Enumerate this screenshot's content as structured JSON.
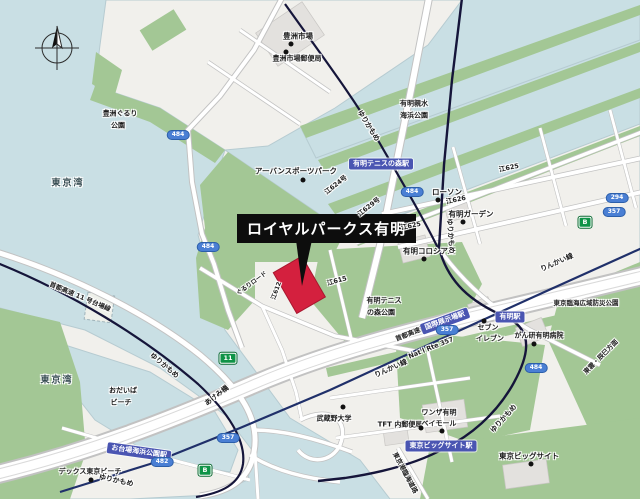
{
  "title": {
    "text": "ロイヤルパークス有明"
  },
  "colors": {
    "water": "#c9dfe4",
    "land": "#f1f0ec",
    "park": "#a3c795",
    "marker_red": "#d4203e",
    "rail_dark": "#15153a",
    "rinkai_blue": "#20306a",
    "station_badge_blue": "#4a55b2",
    "route_badge_blue": "#4a7fd4",
    "shield_green": "#0f9347"
  },
  "compass": {
    "name": "north-compass"
  },
  "sea_labels": [
    {
      "name": "tokyo-bay-north",
      "text": "東京湾",
      "x": 68,
      "y": 184,
      "s": 9
    },
    {
      "name": "tokyo-bay-south",
      "text": "東京湾",
      "x": 57,
      "y": 381,
      "s": 9
    }
  ],
  "poi_labels": [
    {
      "name": "toyosu-market",
      "text": "豊洲市場",
      "x": 298,
      "y": 36,
      "s": 7.5
    },
    {
      "name": "toyosu-post-office",
      "text": "豊洲市場郵便局",
      "x": 297,
      "y": 59,
      "s": 7
    },
    {
      "name": "toyosu-gururi-park-1",
      "text": "豊洲ぐるり",
      "x": 120,
      "y": 114,
      "s": 7
    },
    {
      "name": "toyosu-gururi-park-2",
      "text": "公園",
      "x": 118,
      "y": 126,
      "s": 7
    },
    {
      "name": "urban-sports-park",
      "text": "アーバンスポーツパーク",
      "x": 296,
      "y": 171,
      "s": 7.5
    },
    {
      "name": "shinsui-park-1",
      "text": "有明親水",
      "x": 414,
      "y": 104,
      "s": 7
    },
    {
      "name": "shinsui-park-2",
      "text": "海浜公園",
      "x": 414,
      "y": 116,
      "s": 7
    },
    {
      "name": "lawson",
      "text": "ローソン",
      "x": 447,
      "y": 192,
      "s": 7.5
    },
    {
      "name": "ariake-garden",
      "text": "有明ガーデン",
      "x": 471,
      "y": 214,
      "s": 7.5
    },
    {
      "name": "ariake-coliseum",
      "text": "有明コロシアム",
      "x": 429,
      "y": 251,
      "s": 7.5
    },
    {
      "name": "tennis-forest-park-1",
      "text": "有明テニス",
      "x": 384,
      "y": 301,
      "s": 7
    },
    {
      "name": "tennis-forest-park-2",
      "text": "の森公園",
      "x": 381,
      "y": 313,
      "s": 7
    },
    {
      "name": "seven-eleven-1",
      "text": "セブン",
      "x": 488,
      "y": 328,
      "s": 7
    },
    {
      "name": "seven-eleven-2",
      "text": "イレブン",
      "x": 490,
      "y": 339,
      "s": 7
    },
    {
      "name": "cancer-hospital",
      "text": "がん研有明病院",
      "x": 539,
      "y": 336,
      "s": 7
    },
    {
      "name": "bousai-park",
      "text": "東京臨海広域防災公園",
      "x": 586,
      "y": 303,
      "s": 6.5
    },
    {
      "name": "musashino-univ",
      "text": "武蔵野大学",
      "x": 334,
      "y": 419,
      "s": 7
    },
    {
      "name": "tft-post-office",
      "text": "TFT 内郵便局",
      "x": 400,
      "y": 425,
      "s": 7
    },
    {
      "name": "wanza-ariake-1",
      "text": "ワンザ有明",
      "x": 439,
      "y": 413,
      "s": 7
    },
    {
      "name": "wanza-ariake-2",
      "text": "ベイモール",
      "x": 439,
      "y": 424,
      "s": 7
    },
    {
      "name": "tokyo-big-sight",
      "text": "東京ビッグサイト",
      "x": 529,
      "y": 456,
      "s": 7.5
    },
    {
      "name": "odaiba-beach-1",
      "text": "おだいば",
      "x": 123,
      "y": 391,
      "s": 7
    },
    {
      "name": "odaiba-beach-2",
      "text": "ビーチ",
      "x": 121,
      "y": 403,
      "s": 7
    },
    {
      "name": "decks-tokyo-beach",
      "text": "デックス東京ビーチ",
      "x": 90,
      "y": 472,
      "s": 7
    }
  ],
  "poi_dots": [
    {
      "x": 291,
      "y": 44
    },
    {
      "x": 286,
      "y": 52
    },
    {
      "x": 303,
      "y": 180
    },
    {
      "x": 438,
      "y": 200
    },
    {
      "x": 463,
      "y": 222
    },
    {
      "x": 424,
      "y": 259
    },
    {
      "x": 484,
      "y": 321
    },
    {
      "x": 534,
      "y": 344
    },
    {
      "x": 343,
      "y": 407
    },
    {
      "x": 421,
      "y": 428
    },
    {
      "x": 442,
      "y": 431
    },
    {
      "x": 531,
      "y": 464
    },
    {
      "x": 91,
      "y": 480
    }
  ],
  "road_labels": [
    {
      "name": "yurikamome-line-1",
      "text": "ゆりかもめ",
      "x": 368,
      "y": 126,
      "r": 58,
      "s": 7
    },
    {
      "name": "yurikamome-line-2",
      "text": "ゆりかもめ",
      "x": 450,
      "y": 236,
      "r": 86,
      "s": 7
    },
    {
      "name": "yurikamome-line-3",
      "text": "ゆりかもめ",
      "x": 164,
      "y": 366,
      "r": 40,
      "s": 7
    },
    {
      "name": "yurikamome-line-4",
      "text": "ゆりかもめ",
      "x": 116,
      "y": 481,
      "r": 12,
      "s": 7
    },
    {
      "name": "yurikamome-line-5",
      "text": "ゆりかもめ",
      "x": 504,
      "y": 419,
      "r": -48,
      "s": 7
    },
    {
      "name": "rinkai-line-1",
      "text": "りんかい線",
      "x": 557,
      "y": 263,
      "r": -24,
      "s": 7
    },
    {
      "name": "rinkai-line-2",
      "text": "りんかい線",
      "x": 391,
      "y": 369,
      "r": -24,
      "s": 7
    },
    {
      "name": "wangan-expressway",
      "text": "首都高速湾岸線",
      "x": 417,
      "y": 331,
      "r": -22,
      "s": 6.5
    },
    {
      "name": "national-route-357",
      "text": "Nat'l Rte 357",
      "x": 431,
      "y": 348,
      "r": -22,
      "s": 6.5
    },
    {
      "name": "shuto-11-daiba",
      "text": "首都高速 11 号台場線",
      "x": 80,
      "y": 297,
      "r": 23,
      "s": 6.5
    },
    {
      "name": "akemi-bridge",
      "text": "あけみ橋",
      "x": 217,
      "y": 396,
      "r": -38,
      "s": 7
    },
    {
      "name": "shinonome-tatsumi",
      "text": "東雲・辰巳方面",
      "x": 601,
      "y": 357,
      "r": -45,
      "s": 6.5
    },
    {
      "name": "rinkai-road",
      "text": "東京港臨海道路",
      "x": 405,
      "y": 473,
      "r": 62,
      "s": 6.5
    },
    {
      "name": "road-e624",
      "text": "江624号",
      "x": 336,
      "y": 185,
      "r": -38,
      "s": 6.5
    },
    {
      "name": "road-e629",
      "text": "江629号",
      "x": 369,
      "y": 207,
      "r": -38,
      "s": 6.5
    },
    {
      "name": "road-e612",
      "text": "江612",
      "x": 277,
      "y": 291,
      "r": -70,
      "s": 6
    },
    {
      "name": "gururi-road",
      "text": "ぐるりロード",
      "x": 252,
      "y": 284,
      "r": -36,
      "s": 6
    },
    {
      "name": "road-e625-a",
      "text": "江625",
      "x": 509,
      "y": 168,
      "r": -12,
      "s": 6.5
    },
    {
      "name": "road-e626",
      "text": "江626",
      "x": 456,
      "y": 200,
      "r": -12,
      "s": 6.5
    },
    {
      "name": "road-e625-b",
      "text": "江625",
      "x": 411,
      "y": 226,
      "r": -12,
      "s": 6.5
    },
    {
      "name": "road-e615",
      "text": "江615",
      "x": 337,
      "y": 281,
      "r": -15,
      "s": 6.5
    }
  ],
  "station_badges": [
    {
      "name": "ariake-tennis-no-mori-station",
      "text": "有明テニスの森駅",
      "x": 381,
      "y": 164,
      "r": 0
    },
    {
      "name": "ariake-station",
      "text": "有明駅",
      "x": 510,
      "y": 317,
      "r": 0
    },
    {
      "name": "kokusai-tenjijo-station",
      "text": "国際展示場駅",
      "x": 445,
      "y": 321,
      "r": -20
    },
    {
      "name": "tokyo-big-sight-station",
      "text": "東京ビッグサイト駅",
      "x": 441,
      "y": 446,
      "r": 0
    },
    {
      "name": "odaiba-kaihin-koen-station",
      "text": "お台場海浜公園駅",
      "x": 139,
      "y": 452,
      "r": 8
    }
  ],
  "route_badges": [
    {
      "name": "route-484-a",
      "text": "484",
      "x": 178,
      "y": 135,
      "kind": "oval"
    },
    {
      "name": "route-484-b",
      "text": "484",
      "x": 208,
      "y": 247,
      "kind": "oval"
    },
    {
      "name": "route-484-c",
      "text": "484",
      "x": 412,
      "y": 192,
      "kind": "oval"
    },
    {
      "name": "route-484-d",
      "text": "484",
      "x": 536,
      "y": 368,
      "kind": "oval"
    },
    {
      "name": "route-357-a",
      "text": "357",
      "x": 447,
      "y": 330,
      "kind": "oval"
    },
    {
      "name": "route-357-b",
      "text": "357",
      "x": 228,
      "y": 438,
      "kind": "oval"
    },
    {
      "name": "route-294",
      "text": "294",
      "x": 617,
      "y": 198,
      "kind": "oval"
    },
    {
      "name": "route-357-c",
      "text": "357",
      "x": 614,
      "y": 212,
      "kind": "oval"
    },
    {
      "name": "route-482",
      "text": "482",
      "x": 162,
      "y": 462,
      "kind": "oval"
    },
    {
      "name": "shuto-11-shield",
      "text": "11",
      "x": 228,
      "y": 358,
      "kind": "shield"
    },
    {
      "name": "wangan-b-shield-1",
      "text": "B",
      "x": 585,
      "y": 222,
      "kind": "shield"
    },
    {
      "name": "wangan-b-shield-2",
      "text": "B",
      "x": 205,
      "y": 470,
      "kind": "shield"
    }
  ]
}
